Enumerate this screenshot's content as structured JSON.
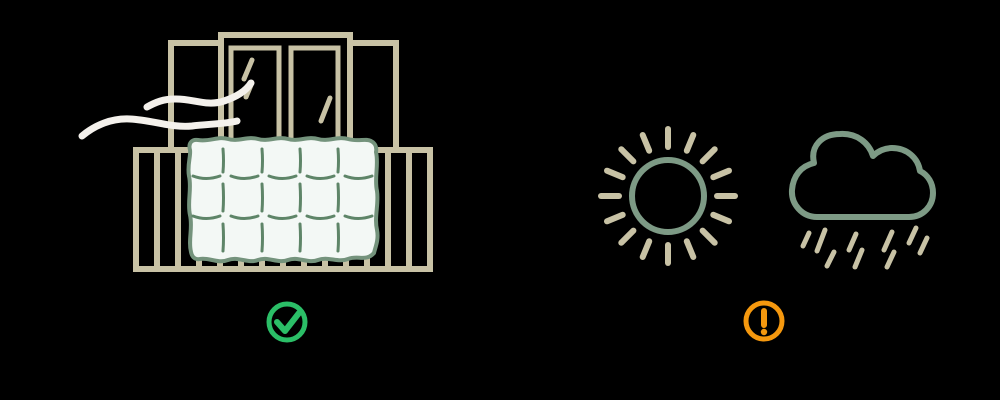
{
  "colors": {
    "background": "#000000",
    "frame-beige": "#c8c2a5",
    "sage-green": "#7d9a85",
    "duvet-outline": "#74937c",
    "stitch-green": "#5e8568",
    "duvet-fill": "#f3f8f5",
    "wind-white": "#f4f1ec",
    "success-green": "#2bbe67",
    "warning-orange": "#f5980e"
  },
  "scenes": {
    "left": {
      "label": "Quilted duvet airing over a balcony railing in front of open balcony doors with fresh-air wind lines",
      "status_icon": "check-circle",
      "icons": [
        "window-door-frame",
        "glass-reflection",
        "wind-lines",
        "balcony-railing",
        "quilted-duvet",
        "check-circle"
      ]
    },
    "right": {
      "label": "Sunshine and a rain cloud",
      "status_icon": "warning-circle",
      "icons": [
        "sun",
        "rain-cloud",
        "rain-drops",
        "warning-circle"
      ]
    }
  }
}
